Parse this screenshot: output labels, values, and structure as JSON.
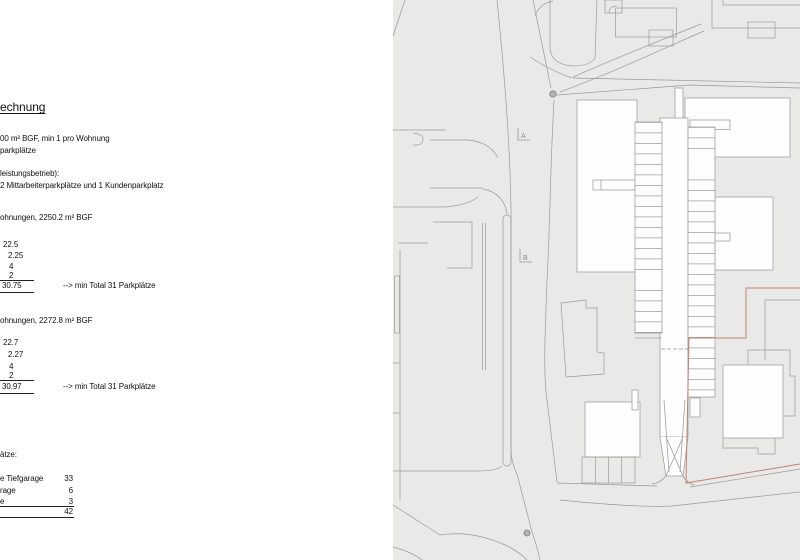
{
  "panel": {
    "title": "echnung",
    "intro": {
      "line1": "00 m² BGF, min 1 pro Wohnung",
      "line2": "parkplätze",
      "line3": "leistungsbetrieb):",
      "line4": "2 Mittarbeiterparkplätze und 1 Kundenparkplatz"
    },
    "block1": {
      "heading": "ohnungen, 2250.2 m² BGF",
      "v1": "22.5",
      "v2": "2.25",
      "v3": "4",
      "v4": "2",
      "total": "30.75",
      "note": "--> min Total 31 Parkplätze"
    },
    "block2": {
      "heading": "ohnungen, 2272.8 m² BGF",
      "v1": "22.7",
      "v2": "2.27",
      "v3": "4",
      "v4": "2",
      "total": "30.97",
      "note": "--> min Total 31 Parkplätze"
    },
    "summary": {
      "heading": "ätze:",
      "r1_label": "e Tiefgarage",
      "r1_value": "33",
      "r2_label": "rage",
      "r2_value": "6",
      "r3_label": "e",
      "r3_value": "3",
      "total": "42"
    }
  },
  "plan": {
    "markers": {
      "a": "A",
      "b": "B"
    },
    "colors": {
      "background": "#e9e9e8",
      "road_line": "#9a9a9a",
      "building_fill": "#fdfdfd",
      "building_stroke": "#a0a0a0",
      "boundary_red": "#bf8274"
    }
  }
}
